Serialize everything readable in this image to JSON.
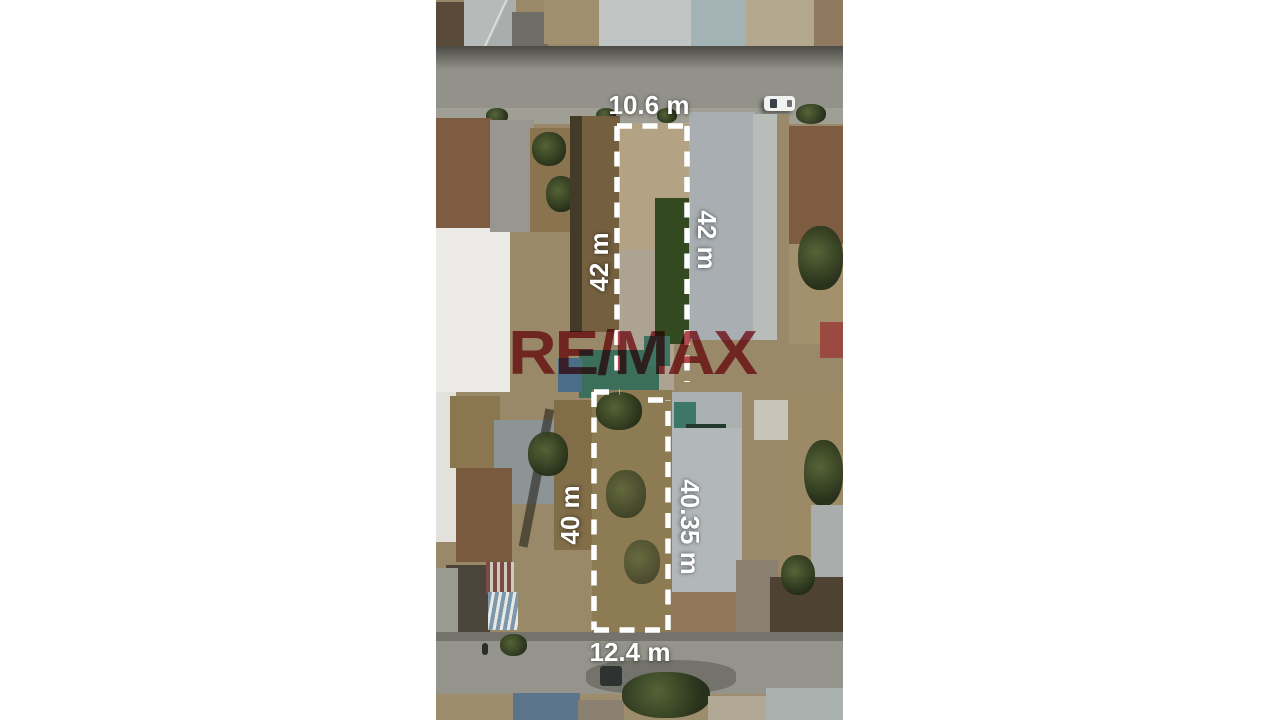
{
  "annotations": {
    "line_color": "#ffffff",
    "text_color": "#ffffff",
    "upper_plot": {
      "top_width": "10.6 m",
      "left_depth": "42 m",
      "right_depth": "42 m"
    },
    "lower_plot": {
      "left_depth": "40 m",
      "right_depth": "40.35 m",
      "bottom_width": "12.4 m"
    }
  },
  "watermark": {
    "text": "RE/MAX",
    "color": "#a81e28"
  }
}
